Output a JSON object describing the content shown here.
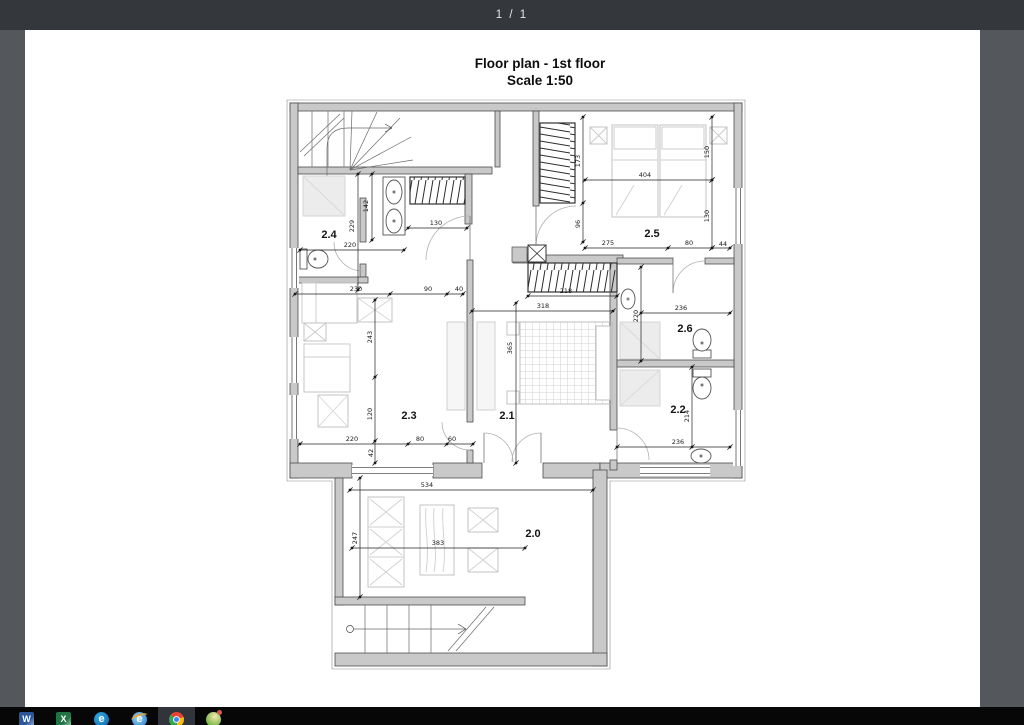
{
  "toolbar": {
    "page_indicator": "1 / 1"
  },
  "document": {
    "title_line1": "Floor plan - 1st floor",
    "title_line2": "Scale 1:50"
  },
  "floorplan": {
    "rooms": [
      {
        "id": "2.0",
        "x": 533,
        "y": 537
      },
      {
        "id": "2.1",
        "x": 507,
        "y": 419
      },
      {
        "id": "2.2",
        "x": 678,
        "y": 413
      },
      {
        "id": "2.3",
        "x": 409,
        "y": 419
      },
      {
        "id": "2.4",
        "x": 329,
        "y": 238
      },
      {
        "id": "2.5",
        "x": 652,
        "y": 237
      },
      {
        "id": "2.6",
        "x": 685,
        "y": 332
      }
    ],
    "dimensions": [
      {
        "label": "220",
        "x": 350,
        "y": 247,
        "rot": 0
      },
      {
        "label": "130",
        "x": 436,
        "y": 225,
        "rot": 0
      },
      {
        "label": "230",
        "x": 356,
        "y": 291,
        "rot": 0
      },
      {
        "label": "90",
        "x": 428,
        "y": 291,
        "rot": 0
      },
      {
        "label": "40",
        "x": 459,
        "y": 291,
        "rot": 0
      },
      {
        "label": "404",
        "x": 645,
        "y": 177,
        "rot": 0
      },
      {
        "label": "275",
        "x": 608,
        "y": 245,
        "rot": 0
      },
      {
        "label": "80",
        "x": 689,
        "y": 245,
        "rot": 0
      },
      {
        "label": "44",
        "x": 723,
        "y": 246,
        "rot": 0
      },
      {
        "label": "218",
        "x": 566,
        "y": 293,
        "rot": 0
      },
      {
        "label": "318",
        "x": 543,
        "y": 308,
        "rot": 0
      },
      {
        "label": "220",
        "x": 352,
        "y": 441,
        "rot": 0
      },
      {
        "label": "80",
        "x": 420,
        "y": 441,
        "rot": 0
      },
      {
        "label": "60",
        "x": 452,
        "y": 441,
        "rot": 0
      },
      {
        "label": "236",
        "x": 681,
        "y": 310,
        "rot": 0
      },
      {
        "label": "236",
        "x": 678,
        "y": 444,
        "rot": 0
      },
      {
        "label": "534",
        "x": 427,
        "y": 487,
        "rot": 0
      },
      {
        "label": "383",
        "x": 438,
        "y": 545,
        "rot": 0
      },
      {
        "label": "229",
        "x": 354,
        "y": 226,
        "rot": -90
      },
      {
        "label": "142",
        "x": 368,
        "y": 206,
        "rot": -90
      },
      {
        "label": "173",
        "x": 580,
        "y": 161,
        "rot": -90
      },
      {
        "label": "96",
        "x": 580,
        "y": 224,
        "rot": -90
      },
      {
        "label": "150",
        "x": 709,
        "y": 152,
        "rot": -90
      },
      {
        "label": "130",
        "x": 709,
        "y": 216,
        "rot": -90
      },
      {
        "label": "365",
        "x": 512,
        "y": 348,
        "rot": -90
      },
      {
        "label": "243",
        "x": 372,
        "y": 337,
        "rot": -90
      },
      {
        "label": "120",
        "x": 372,
        "y": 414,
        "rot": -90
      },
      {
        "label": "42",
        "x": 373,
        "y": 453,
        "rot": -90
      },
      {
        "label": "220",
        "x": 638,
        "y": 316,
        "rot": -90
      },
      {
        "label": "214",
        "x": 689,
        "y": 416,
        "rot": -90
      },
      {
        "label": "247",
        "x": 357,
        "y": 538,
        "rot": -90
      }
    ]
  },
  "taskbar": {
    "icons": [
      {
        "name": "word"
      },
      {
        "name": "excel"
      },
      {
        "name": "edge"
      },
      {
        "name": "internet-explorer"
      },
      {
        "name": "chrome",
        "active": true
      },
      {
        "name": "globe-app"
      }
    ]
  },
  "colors": {
    "toolbar_bg": "#34373b",
    "canvas_bg": "#54575b",
    "page_bg": "#ffffff",
    "wall_fill": "#c9c9c9",
    "taskbar_bg": "#070708",
    "active_tile": "#31343a"
  }
}
